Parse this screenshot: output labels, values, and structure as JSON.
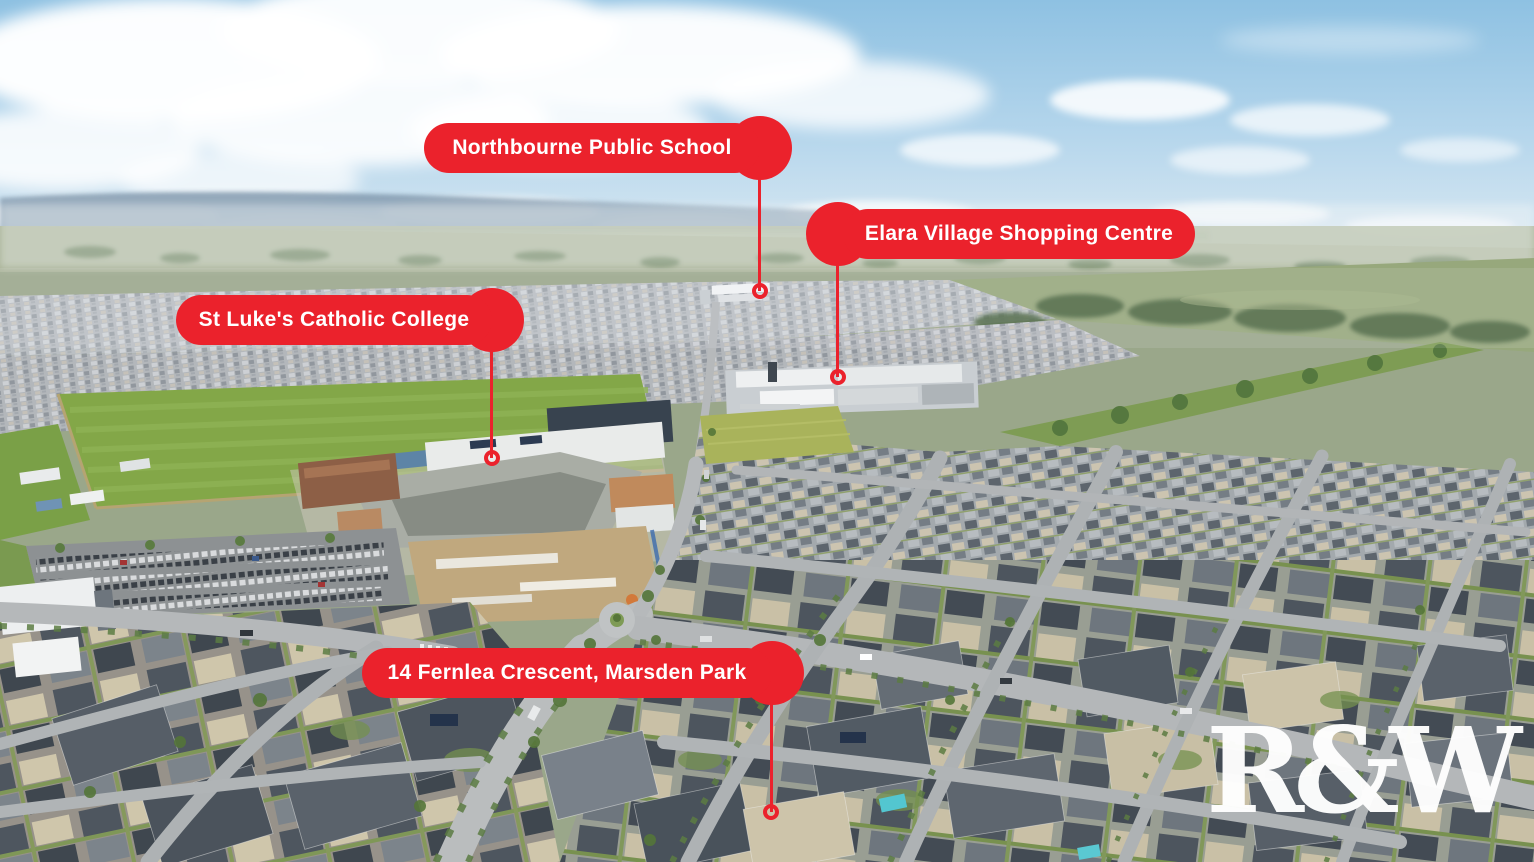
{
  "scene": {
    "description": "Aerial drone photograph of a Marsden Park housing estate: dense suburban rooftops in the foreground, St Luke's Catholic College campus with bright green sports fields at centre-left, Elara Village Shopping Centre in the middle distance, green pastures and a hazy blue mountain range on the horizon under a partly cloudy sky.",
    "palette": {
      "sky_blue": "#8EC1E2",
      "cloud_white": "#FFFFFF",
      "mountain_blue": "#7E95AA",
      "field_green": "#83A748",
      "roof_grey": "#59616A",
      "roof_beige": "#CDC4AA",
      "road_grey": "#B9BCBD"
    }
  },
  "callouts": [
    {
      "id": "northbourne-public-school",
      "label": "Northbourne Public School",
      "pointer_side": "right"
    },
    {
      "id": "elara-village-shopping-centre",
      "label": "Elara Village Shopping Centre",
      "pointer_side": "left"
    },
    {
      "id": "st-lukes-catholic-college",
      "label": "St Luke's Catholic College",
      "pointer_side": "right"
    },
    {
      "id": "14-fernlea-crescent-marsden-park",
      "label": "14 Fernlea Crescent, Marsden Park",
      "pointer_side": "right"
    }
  ],
  "watermark": {
    "text": "R&W"
  },
  "colors": {
    "callout_red": "#EB222C",
    "callout_text": "#FFFFFF",
    "watermark": "#FFFFFF"
  }
}
